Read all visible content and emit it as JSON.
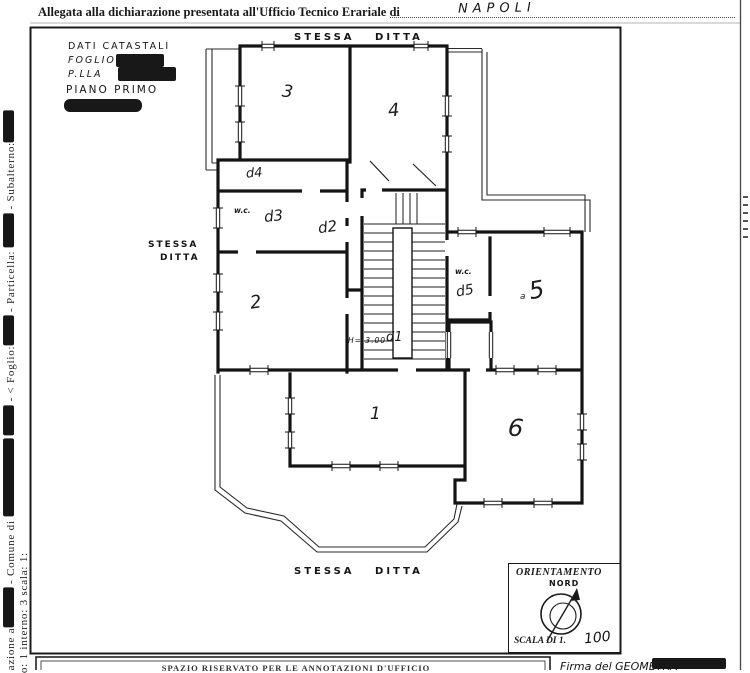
{
  "header": {
    "label": "Allegata alla dichiarazione presentata all'Ufficio Tecnico Erariale di",
    "city": "NAPOLI"
  },
  "sidebar": {
    "segments": [
      "azione a",
      " - Comune di ",
      " - < Foglio:",
      " - Particella: ",
      " - Subalterno:"
    ],
    "inner_line": "o: 1 interno: 3 scala: 1:"
  },
  "cadastral": {
    "title": "DATI CATASTALI",
    "foglio_label": "FOGLIO",
    "particella_label": "P.LLA",
    "piano": "PIANO PRIMO"
  },
  "annotations": {
    "stessa_ditta_top": "STESSA DITTA",
    "stessa_ditta_left_1": "STESSA",
    "stessa_ditta_left_2": "DITTA",
    "stessa_ditta_bottom": "STESSA DITTA",
    "height_note": "H= 3.00"
  },
  "rooms": {
    "r1": "1",
    "r2": "2",
    "r3": "3",
    "r4": "4",
    "r5": "5",
    "r5_prefix": "a",
    "r6": "6",
    "d1": "d1",
    "d2": "d2",
    "d3": "d3",
    "d4": "d4",
    "d5": "d5",
    "wc_left": "w.c.",
    "wc_right": "w.c."
  },
  "orientation": {
    "title": "ORIENTAMENTO",
    "north": "NORD",
    "scale_label": "SCALA DI 1.",
    "scale_value": "100"
  },
  "footer": {
    "office_box": "SPAZIO RISERVATO PER LE ANNOTAZIONI D'UFFICIO",
    "signature_label": "Firma del GEOMETRA"
  },
  "colors": {
    "ink": "#1a1a1a",
    "paper": "#ffffff"
  }
}
